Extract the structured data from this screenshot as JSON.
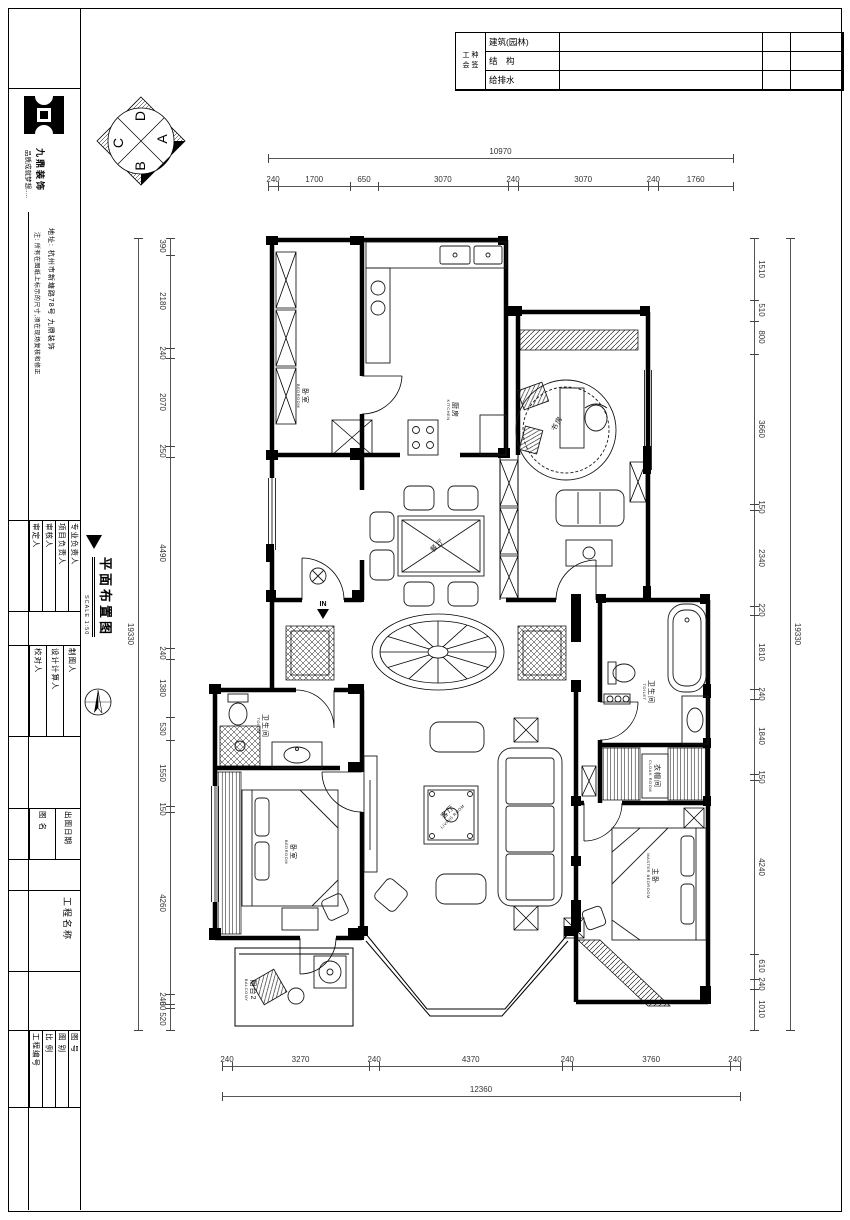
{
  "signoff": {
    "header_lines": [
      "工 种",
      "会 签"
    ],
    "rows": [
      "建筑(园林)",
      "结　构",
      "给排水"
    ]
  },
  "sidebar": {
    "brand": "九鼎装饰",
    "slogan": "品质成就梦想.....",
    "address": "地址: 杭州市新塘路78号 九鼎装饰",
    "note": "注: 所有在图纸上标示的尺寸,须在现场复核和修正",
    "roles_a": [
      "审定人",
      "审核人",
      "项目负责人",
      "专业负责人"
    ],
    "roles_b": [
      "校对人",
      "设计计算人",
      "制图人"
    ],
    "doc_fields": [
      "图 名",
      "出图日期"
    ],
    "project_label": "工程名称",
    "footer_fields": [
      "工程编号",
      "比 例",
      "图 别",
      "图 号"
    ]
  },
  "title_block": {
    "name": "平面布置图",
    "scale": "SCALE 1:50"
  },
  "compass": {
    "letters": {
      "top": "D",
      "right": "A",
      "bottom": "B",
      "left": "C"
    }
  },
  "entry": {
    "label": "IN"
  },
  "rooms": {
    "bedroom_top": {
      "cn": "卧室",
      "en": "BEDROOM"
    },
    "kitchen": {
      "cn": "厨房",
      "en": "KITCHEN"
    },
    "study": {
      "cn": "书房",
      "en": ""
    },
    "dining": {
      "cn": "餐厅",
      "en": ""
    },
    "living": {
      "cn": "客厅",
      "en": "LIVING ROOM"
    },
    "toilet_left": {
      "cn": "卫生间",
      "en": "TOILET"
    },
    "bedroom_left": {
      "cn": "卧室",
      "en": "BEDROOM"
    },
    "balcony": {
      "cn": "阳台2",
      "en": "BALCONY"
    },
    "toilet_master": {
      "cn": "卫生间",
      "en": "TOILET"
    },
    "cloak": {
      "cn": "衣帽间",
      "en": "CLOAK ROOM"
    },
    "master": {
      "cn": "主卧",
      "en": "MASTER BEDROOM"
    }
  },
  "dimensions": {
    "top": {
      "overall": "10970",
      "segments": [
        240,
        1700,
        650,
        3070,
        240,
        3070,
        240,
        1760
      ]
    },
    "bottom": {
      "overall": "12360",
      "segments": [
        240,
        3270,
        240,
        4370,
        240,
        3760,
        240
      ]
    },
    "left": {
      "overall": "19330",
      "segments": [
        390,
        2180,
        240,
        2070,
        250,
        4490,
        240,
        1380,
        530,
        1550,
        150,
        4260,
        240,
        80,
        520
      ]
    },
    "right": {
      "overall": "19330",
      "segments": [
        1510,
        510,
        800,
        3660,
        150,
        2340,
        220,
        1810,
        240,
        1840,
        150,
        4240,
        610,
        240,
        1010
      ]
    }
  }
}
